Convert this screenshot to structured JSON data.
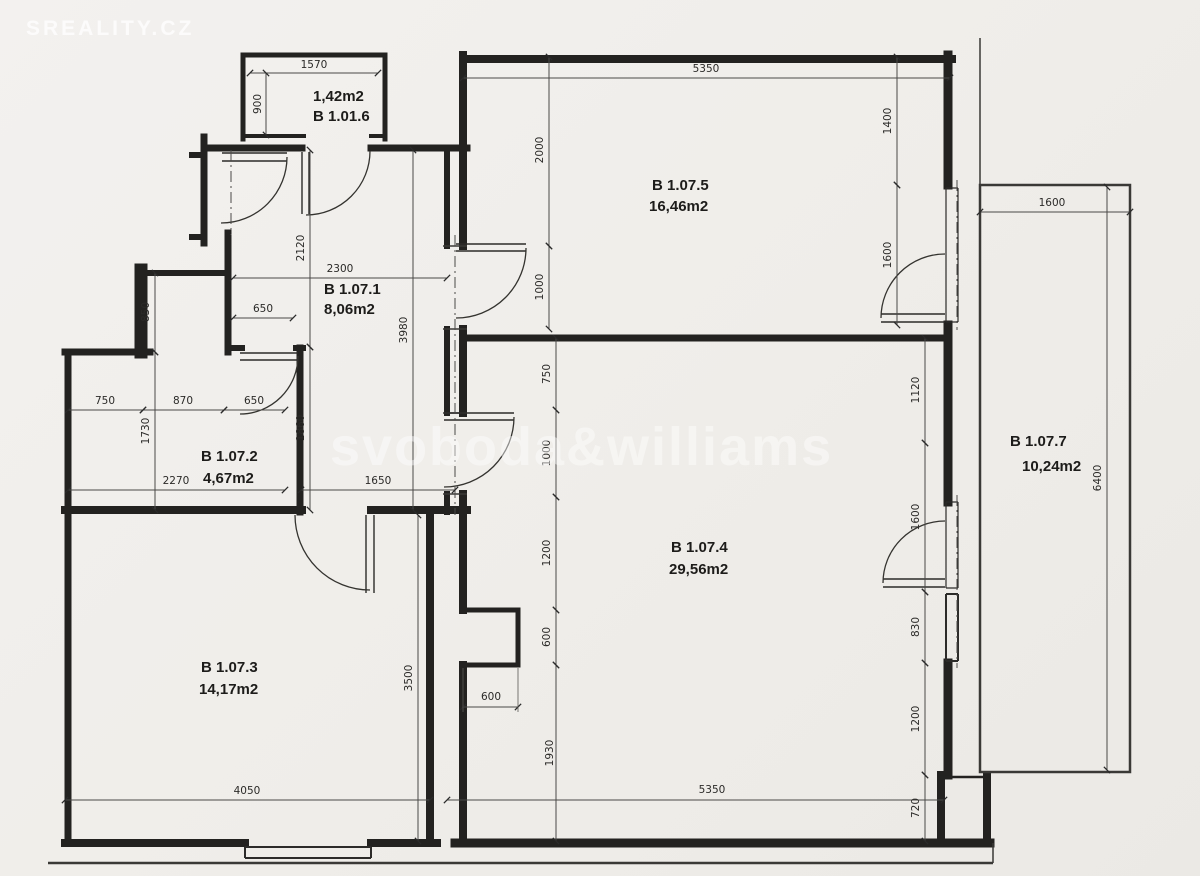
{
  "watermarks": {
    "top_left": "SREALITY.CZ",
    "center": "svoboda&williams"
  },
  "rooms": [
    {
      "id": "B 1.01.6",
      "area": "1,42m2"
    },
    {
      "id": "B 1.07.1",
      "area": "8,06m2"
    },
    {
      "id": "B 1.07.2",
      "area": "4,67m2"
    },
    {
      "id": "B 1.07.3",
      "area": "14,17m2"
    },
    {
      "id": "B 1.07.4",
      "area": "29,56m2"
    },
    {
      "id": "B 1.07.5",
      "area": "16,46m2"
    },
    {
      "id": "B 1.07.7",
      "area": "10,24m2"
    }
  ],
  "dims": {
    "vestibule_width": "1570",
    "vestibule_depth": "900",
    "room5_top_width": "5350",
    "room5_left_upper": "2000",
    "room5_left_door": "1000",
    "room5_right_upper": "1400",
    "room5_right_door": "1600",
    "entry_height": "2120",
    "hall_width": "2300",
    "hall_shaft_width": "650",
    "hall_right_height": "3980",
    "bath_upper_height": "850",
    "bath_seg_left": "750",
    "bath_seg_mid": "870",
    "bath_door_width": "650",
    "bath_lower_height": "1730",
    "bath_bottom_width": "2270",
    "hall_lower_height": "1860",
    "hall_bottom_width": "1650",
    "room4_left_upper": "750",
    "room4_left_door": "1000",
    "room4_left_mid": "1200",
    "room4_niche_height": "600",
    "room4_niche_depth": "600",
    "room4_left_lower": "1930",
    "room3_height": "3500",
    "room3_width": "4050",
    "room4_bottom_width": "5350",
    "room4_right_upper": "1120",
    "room4_right_door": "1600",
    "room4_right_window": "830",
    "room4_right_mid": "1200",
    "room4_right_lower": "720",
    "balcony_width": "1600",
    "balcony_length": "6400"
  }
}
